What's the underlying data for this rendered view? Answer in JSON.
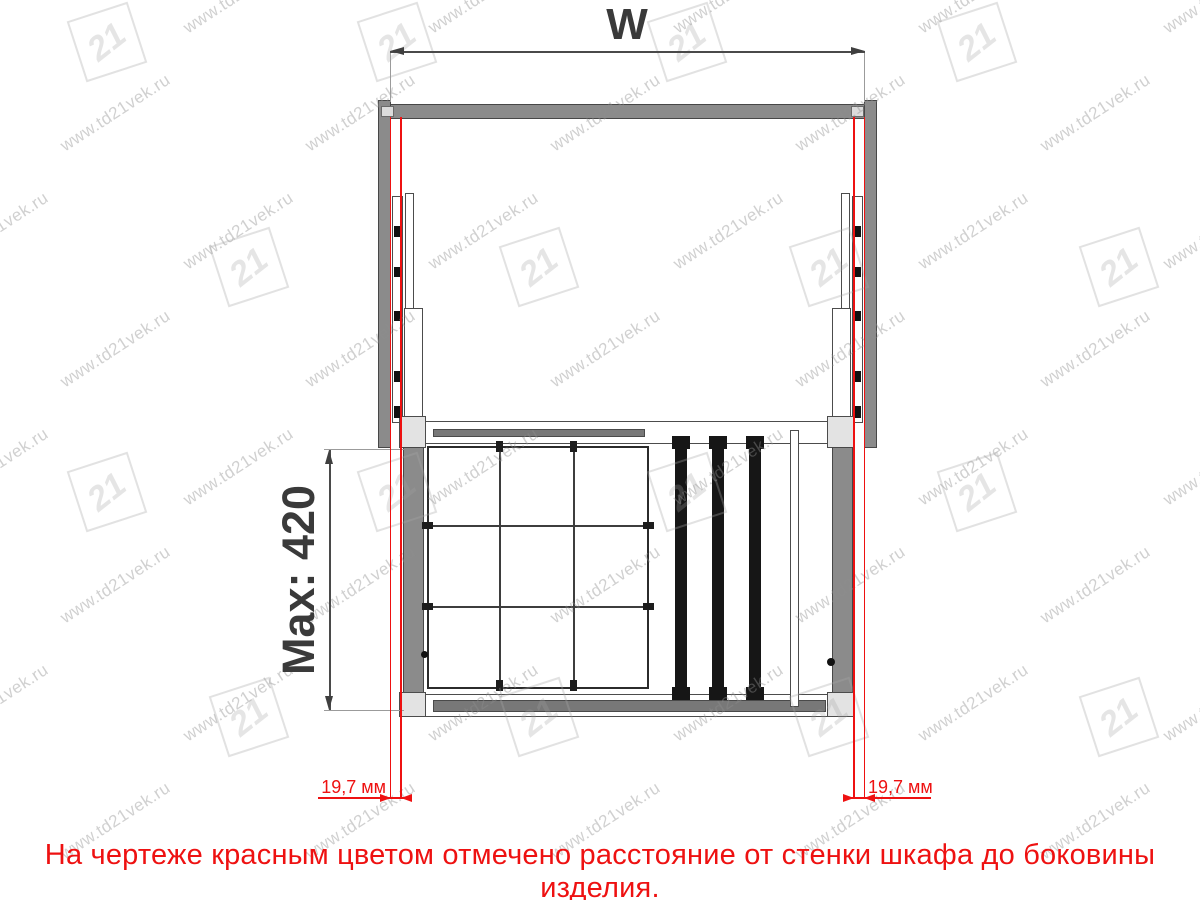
{
  "drawing": {
    "width_label": "W",
    "depth_label": "Max: 420",
    "left_clearance_label": "19,7 мм",
    "right_clearance_label": "19,7 мм"
  },
  "note": "На чертеже красным цветом отмечено расстояние  от стенки шкафа до боковины изделия.",
  "watermark": {
    "text": "www.td21vek.ru",
    "logo": "21"
  },
  "colors": {
    "accent_red": "#ee1111",
    "cabinet_gray": "#8b8b8b",
    "line_dark": "#3f3f3f"
  }
}
